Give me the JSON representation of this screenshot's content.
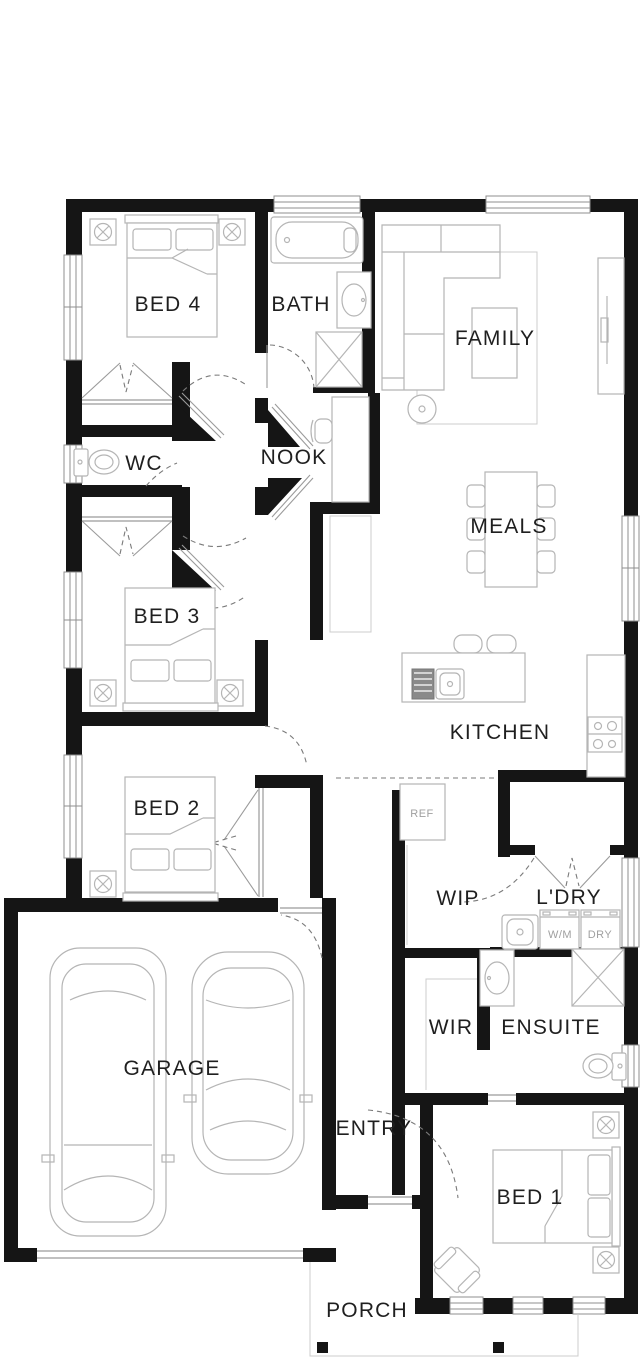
{
  "rooms": [
    {
      "id": "bed4",
      "label": "BED 4"
    },
    {
      "id": "bath",
      "label": "BATH"
    },
    {
      "id": "family",
      "label": "FAMILY"
    },
    {
      "id": "wc",
      "label": "WC"
    },
    {
      "id": "nook",
      "label": "NOOK"
    },
    {
      "id": "meals",
      "label": "MEALS"
    },
    {
      "id": "bed3",
      "label": "BED 3"
    },
    {
      "id": "kitchen",
      "label": "KITCHEN"
    },
    {
      "id": "bed2",
      "label": "BED 2"
    },
    {
      "id": "wip",
      "label": "WIP"
    },
    {
      "id": "ldry",
      "label": "L'DRY"
    },
    {
      "id": "wir",
      "label": "WIR"
    },
    {
      "id": "ensuite",
      "label": "ENSUITE"
    },
    {
      "id": "garage",
      "label": "GARAGE"
    },
    {
      "id": "entry",
      "label": "ENTRY"
    },
    {
      "id": "bed1",
      "label": "BED 1"
    },
    {
      "id": "porch",
      "label": "PORCH"
    }
  ],
  "appliances": [
    {
      "id": "ref",
      "label": "REF"
    },
    {
      "id": "wm",
      "label": "W/M"
    },
    {
      "id": "dry",
      "label": "DRY"
    }
  ]
}
